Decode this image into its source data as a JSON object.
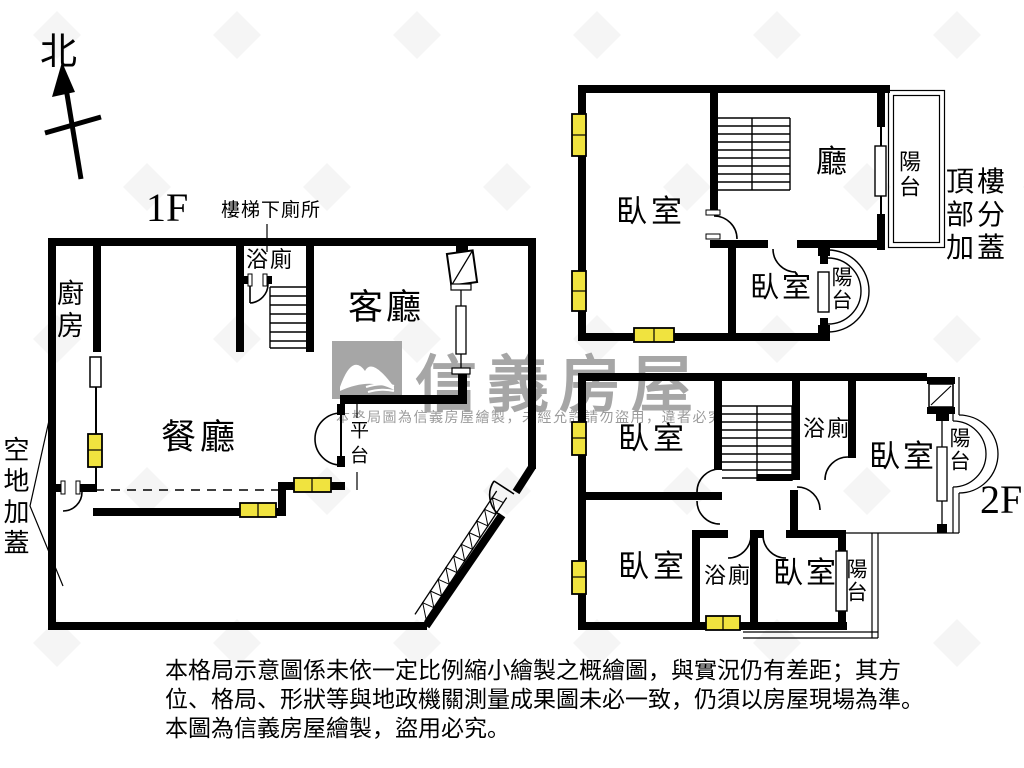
{
  "compass": {
    "north_label": "北"
  },
  "floor1": {
    "floor_label": "1F",
    "stair_note": "樓梯下廁所",
    "kitchen": "廚房",
    "bath": "浴廁",
    "living": "客廳",
    "dining": "餐廳",
    "platform": "平台",
    "outside": "空地加蓋"
  },
  "rooftop": {
    "bedroom": "臥室",
    "hall": "廳",
    "balcony": "陽台",
    "bedroom2": "臥室",
    "balcony2": "陽台",
    "annotation_lines": [
      "頂樓",
      "部分",
      "加蓋"
    ]
  },
  "floor2": {
    "floor_label": "2F",
    "bedroom_tl": "臥室",
    "bath_top": "浴廁",
    "bedroom_tr": "臥室",
    "balcony_top": "陽台",
    "bedroom_bl": "臥室",
    "bath_bottom": "浴廁",
    "bedroom_br": "臥室",
    "balcony_bottom": "陽台"
  },
  "watermark": {
    "brand": "信義房屋",
    "notice": "本格局圖為信義房屋繪製，未經允許請勿盜用，違者必究"
  },
  "disclaimer": {
    "lines": [
      "本格局示意圖係未依一定比例縮小繪製之概繪圖，與實況仍有差距；其方",
      "位、格局、形狀等與地政機關測量成果圖未必一致，仍須以房屋現場為準。",
      "本圖為信義房屋繪製，盜用必究。"
    ]
  },
  "colors": {
    "wall": "#000000",
    "window_highlight": "#f0e33f",
    "watermark_gray": "#a6a6a6"
  }
}
